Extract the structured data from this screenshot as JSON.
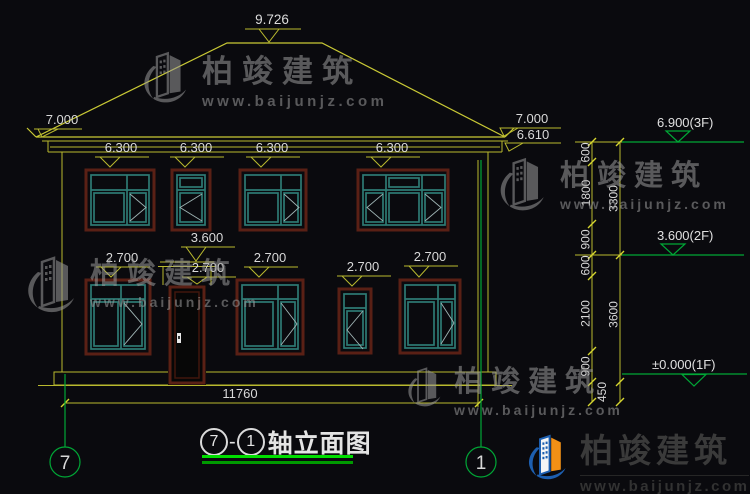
{
  "drawing": {
    "title": {
      "axis_start": "7",
      "separator": "-",
      "axis_end": "1",
      "name": "轴立面图"
    },
    "grid_bubbles": {
      "left": "7",
      "right": "1"
    },
    "spot_elevations": {
      "ridge": "9.726",
      "eave_left": "7.000",
      "eave_right_top": "7.000",
      "eave_right_bottom": "6.610",
      "floor2_window_top": "6.300",
      "door_canopy_top": "3.600",
      "floor1_window_top": "2.700"
    },
    "levels": {
      "f3": "6.900(3F)",
      "f2": "3.600(2F)",
      "f1": "±0.000(1F)"
    },
    "dim_chain": {
      "inner": [
        "600",
        "1800",
        "900",
        "600",
        "2100",
        "900"
      ],
      "base": "450",
      "outer": [
        "3300",
        "3600"
      ]
    },
    "overall_width": "11760"
  },
  "watermark": {
    "brand": "柏竣建筑",
    "url": "www.baijunjz.com"
  },
  "colors": {
    "background": "#0a0a0e",
    "dimension_lines": "#b9b92e",
    "grid_and_levels_green": "#00a736",
    "window_outer_frame": "#5a2015",
    "window_inner_frame": "#2e7a74",
    "dimension_text": "#d9d9d9",
    "title_underline": "#00de00",
    "watermark_gray": "#9b9b9b",
    "logo_blue": "#1d5fb0",
    "logo_orange": "#f19016"
  }
}
